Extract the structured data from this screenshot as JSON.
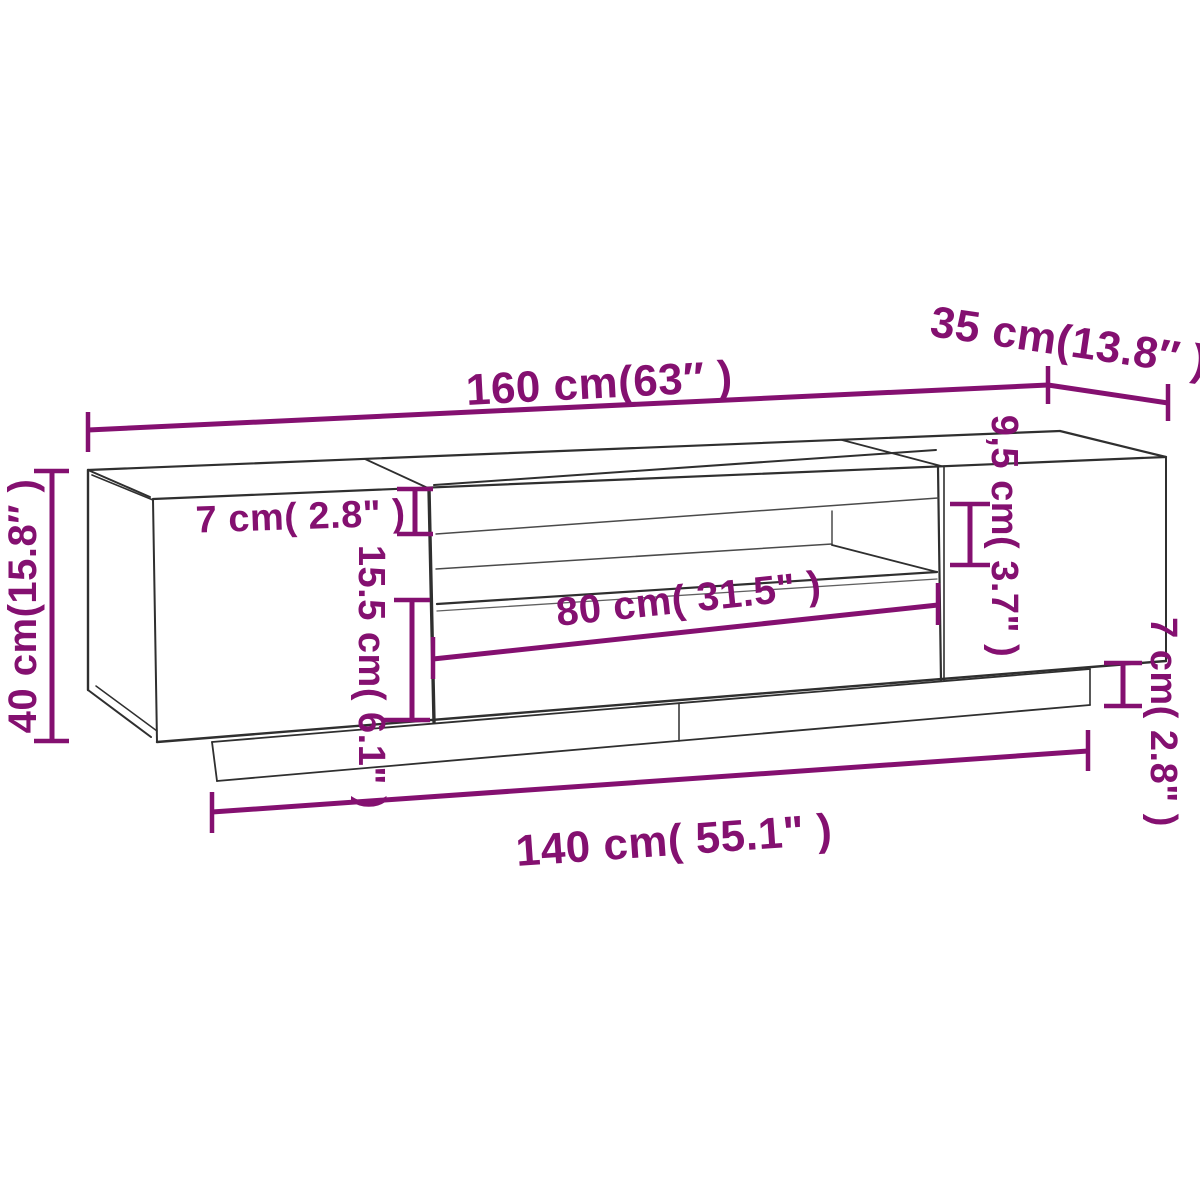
{
  "diagram": {
    "name": "TV stand dimension drawing",
    "colors": {
      "dimension": "#841070",
      "outline": "#2f2f2f",
      "outline_light": "#4a4a4a",
      "background": "#ffffff"
    },
    "dimensions": {
      "overall_width": {
        "label": "160 cm(63″ )"
      },
      "overall_depth": {
        "label": "35 cm(13.8″ )"
      },
      "overall_height": {
        "label": "40 cm(15.8″ )"
      },
      "top_panel_height": {
        "label": "7 cm( 2.8\" )"
      },
      "drawer_front_height": {
        "label": "15.5 cm( 6.1\" )"
      },
      "open_shelf_width": {
        "label": "80 cm( 31.5\" )"
      },
      "open_shelf_height": {
        "label": "9,5 cm( 3.7\" )"
      },
      "plinth_height": {
        "label": "7 cm( 2.8\" )"
      },
      "base_width": {
        "label": "140 cm( 55.1\" )"
      }
    }
  }
}
